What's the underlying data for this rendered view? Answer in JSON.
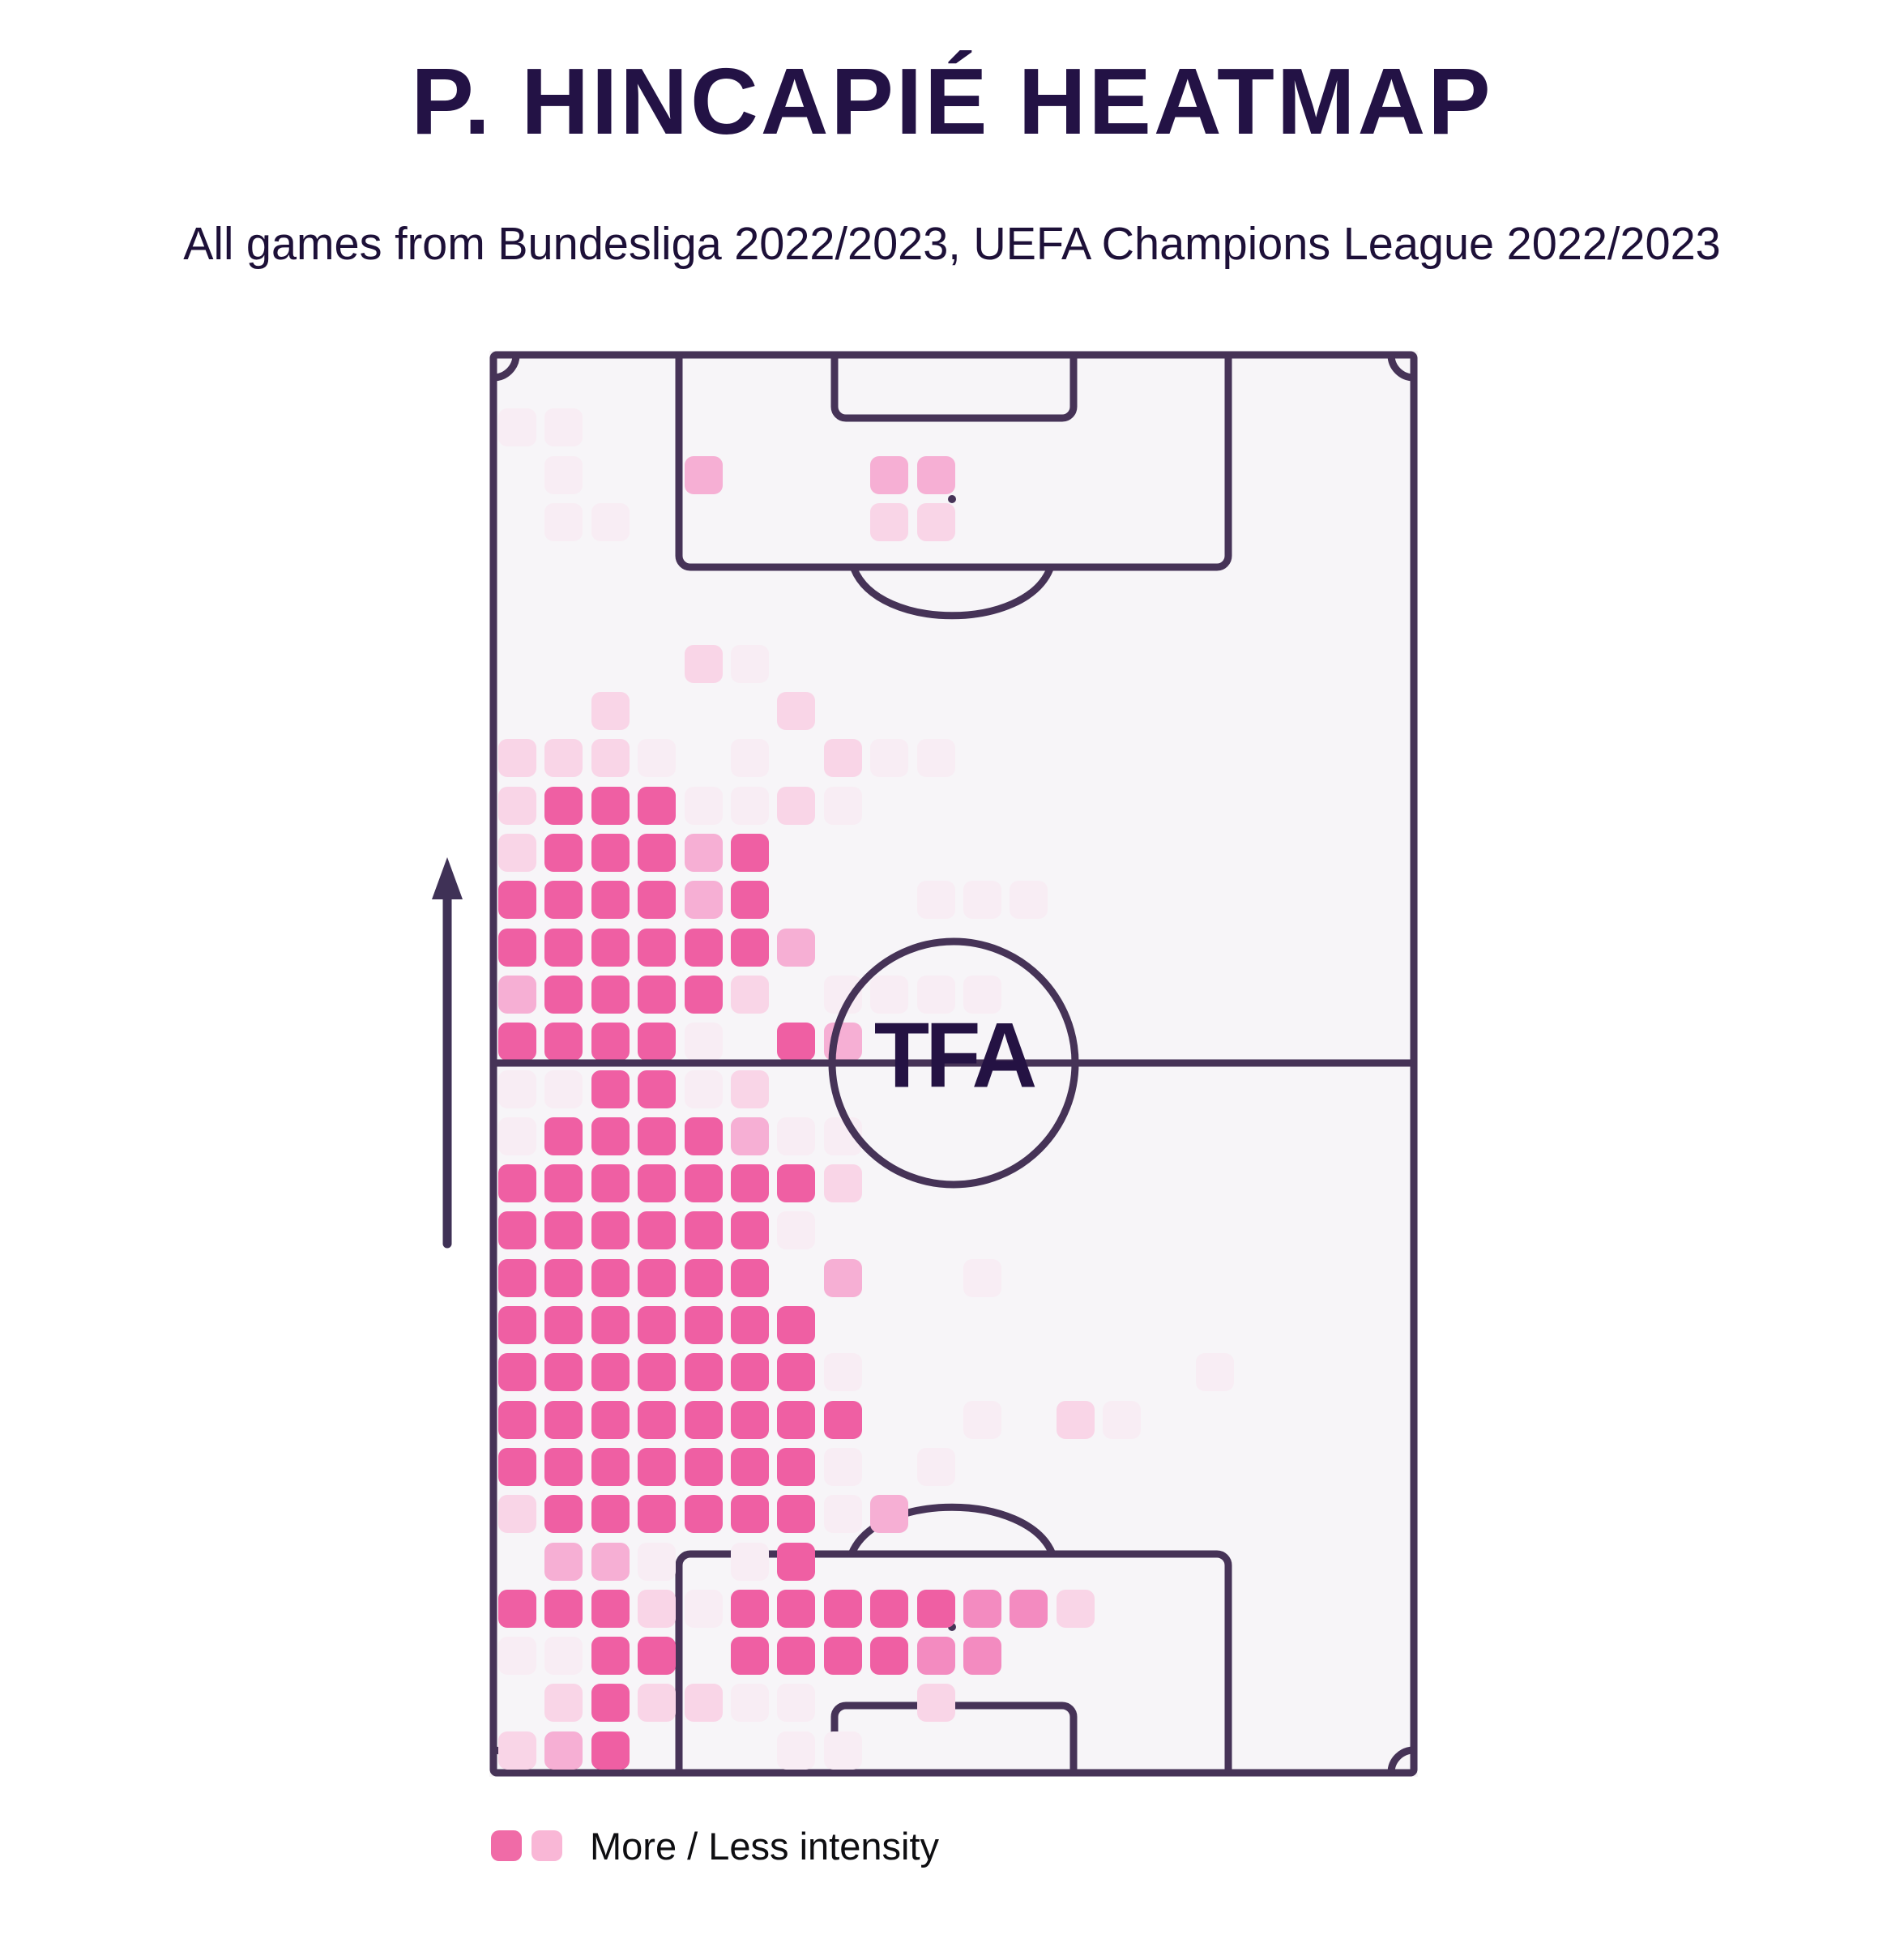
{
  "title": "P. HINCAPIÉ HEATMAP",
  "subtitle": "All games from Bundesliga 2022/2023, UEFA Champions League 2022/2023",
  "watermark": "TFA",
  "legend": {
    "label": "More / Less intensity",
    "more_color": "#F06BA7",
    "less_color": "#F9B7D6"
  },
  "colors": {
    "page_bg": "#FFFFFF",
    "pitch_bg": "#F7F5F8",
    "pitch_line": "#463357",
    "title_text": "#231245",
    "watermark_text": "#241243",
    "arrow": "#3F3156",
    "legend_text": "#0E0E11"
  },
  "chart_data": {
    "type": "heatmap",
    "title": "P. HINCAPIÉ HEATMAP",
    "subtitle": "All games from Bundesliga 2022/2023, UEFA Champions League 2022/2023",
    "description": "Football pitch heatmap, vertical pitch, attacking direction upward (arrow on left). Intensity concentrated on left flank (left centre-back / left-back zone), from own box up to just past halfway line.",
    "orientation": "attack-up",
    "grid_cols": 20,
    "grid_rows": 30,
    "legend": "More / Less intensity",
    "intensity_scale": {
      "0": "none",
      "1": "very low",
      "2": "low",
      "3": "medium",
      "4": "high",
      "5": "highest"
    },
    "palette": {
      "1": "#F8EDF4",
      "2": "#F9D5E7",
      "3": "#F6AFD4",
      "4": "#F38BC0",
      "5": "#EF5FA3"
    },
    "rows": [
      "00000000000000000000",
      "11000000000000000000",
      "01003000330000000000",
      "01100000220000000000",
      "00000000000000000000",
      "00000000000000000000",
      "00002100000000000000",
      "00200020000000000000",
      "22210102110000000000",
      "25551121000000000000",
      "25553500000000000000",
      "55553500011100000000",
      "55555530000000000000",
      "35555201111000000000",
      "55551053000000000000",
      "11551200000000000000",
      "15555311000000000000",
      "55555552000000000000",
      "55555510000000000000",
      "55555503001000000000",
      "55555550000000000000",
      "55555551000000010000",
      "55555555001021000000",
      "55555551010000000000",
      "25555551300000000000",
      "03310150000000000000",
      "55521555554420000000",
      "11550555544000000000",
      "02522110020000000000",
      "23500011000000000000"
    ]
  }
}
